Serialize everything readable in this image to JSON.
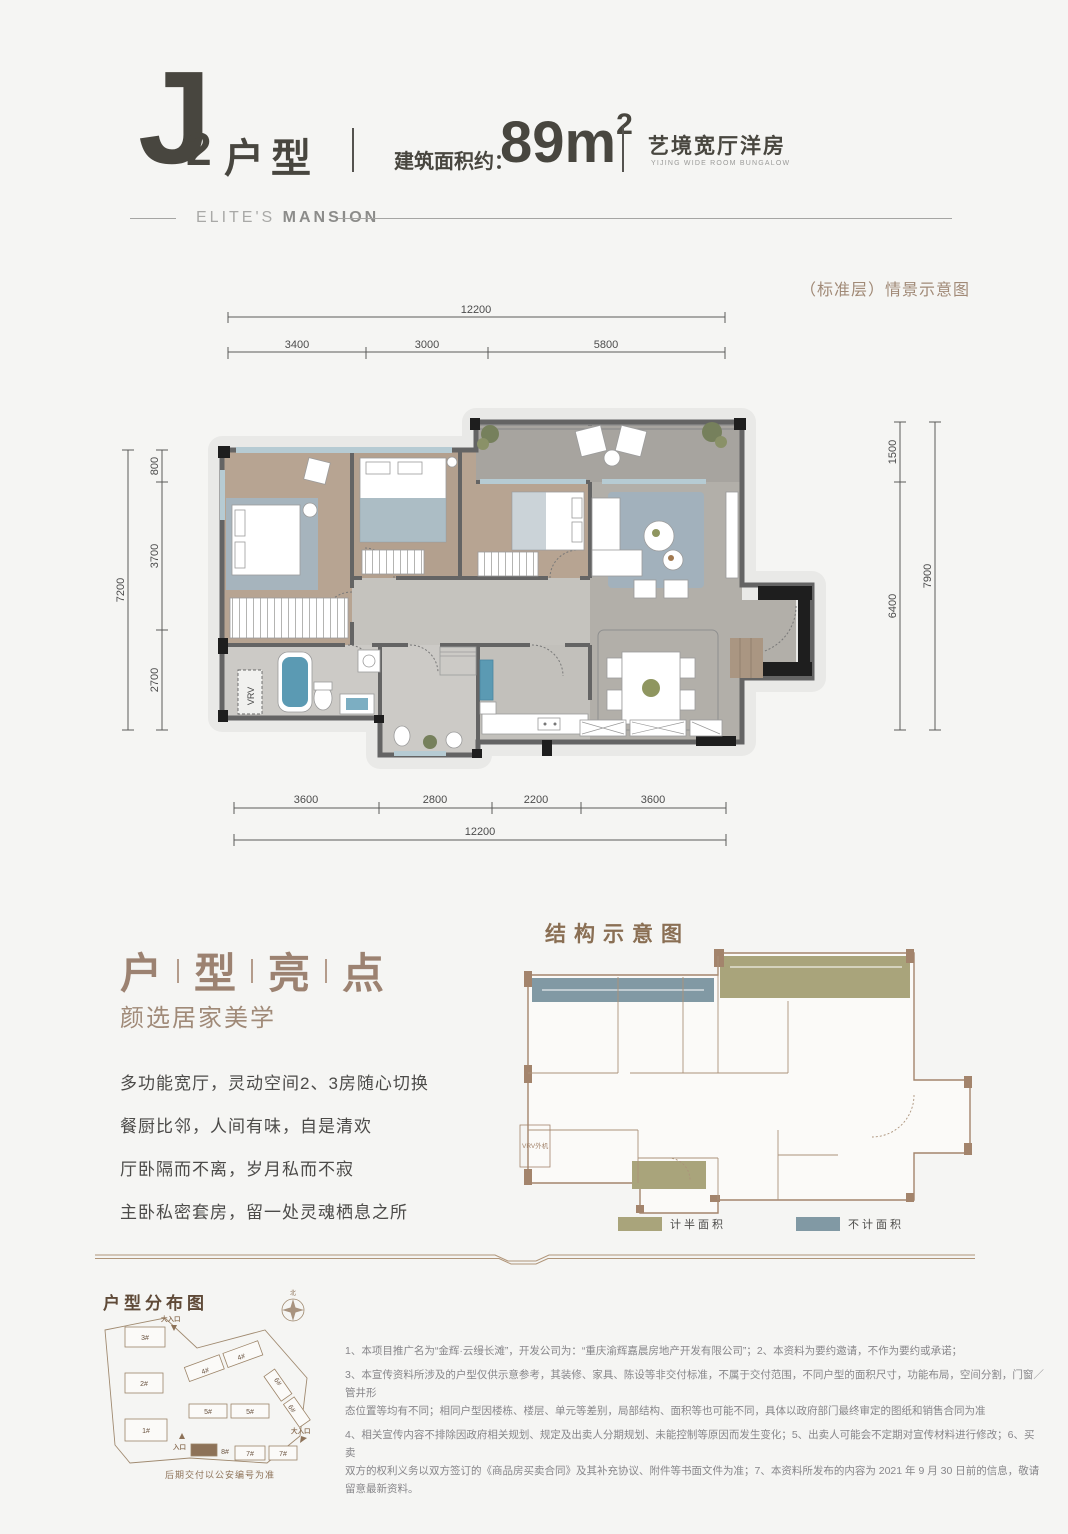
{
  "header": {
    "unit_letter": "J",
    "unit_number": "2",
    "unit_type": "户型",
    "area_label": "建筑面积约：",
    "area_value": "89m",
    "area_exp": "2",
    "tagline_cn": "艺境宽厅洋房",
    "tagline_en": "YIJING WIDE ROOM BUNGALOW",
    "brand_light": "ELITE'S ",
    "brand_bold": "MANSION"
  },
  "plan": {
    "scene_note": "（标准层）情景示意图",
    "vrv_label": "VRV",
    "dims": {
      "top_total": "12200",
      "top_segments": [
        "3400",
        "3000",
        "5800"
      ],
      "left_total": "7200",
      "left_segments": [
        "800",
        "3700",
        "2700"
      ],
      "right_segments": [
        "1500",
        "6400"
      ],
      "right_total": "7900",
      "bottom_segments": [
        "3600",
        "2800",
        "2200",
        "3600"
      ],
      "bottom_total": "12200"
    }
  },
  "highlights": {
    "title_chars": [
      "户",
      "型",
      "亮",
      "点"
    ],
    "subtitle": "颜选居家美学",
    "lines": [
      "多功能宽厅，灵动空间2、3房随心切换",
      "餐厨比邻，人间有味，自是清欢",
      "厅卧隔而不离，岁月私而不寂",
      "主卧私密套房，留一处灵魂栖息之所"
    ]
  },
  "structure": {
    "title": "结构示意图",
    "vrv_label": "VRV外机",
    "legend": [
      {
        "label": "计半面积",
        "color": "#a9a47b"
      },
      {
        "label": "不计面积",
        "color": "#8199a4"
      }
    ]
  },
  "siteplan": {
    "title": "户型分布图",
    "caption": "后期交付以公安编号为准",
    "north": "北",
    "entrance_main_top": "大入口",
    "entrance_left": "入口",
    "entrance_main_right": "大入口",
    "buildings": [
      "3#",
      "2#",
      "1#",
      "4#",
      "4#",
      "5#",
      "5#",
      "6#",
      "6#",
      "8#",
      "7#",
      "7#"
    ]
  },
  "disclaimer": {
    "lines": [
      "1、本项目推广名为“金辉·云缦长滩”，开发公司为：“重庆渝辉嘉晨房地产开发有限公司”；2、本资料为要约邀请，不作为要约或承诺；",
      "3、本宣传资料所涉及的户型仅供示意参考，其装修、家具、陈设等非交付标准，不属于交付范围，不同户型的面积尺寸，功能布局，空间分割，门窗／管井形",
      "态位置等均有不同；相同户型因楼栋、楼层、单元等差别，局部结构、面积等也可能不同，具体以政府部门最终审定的图纸和销售合同为准",
      "4、相关宣传内容不排除因政府相关规划、规定及出卖人分期规划、未能控制等原因而发生变化；5、出卖人可能会不定期对宣传材料进行修改；6、买卖",
      "双方的权利义务以双方签订的《商品房买卖合同》及其补充协议、附件等书面文件为准；7、本资料所发布的内容为 2021 年 9 月 30 日前的信息，敬请留意最新资料。"
    ]
  },
  "colors": {
    "accent_brown": "#a18a77",
    "title_brown": "#9c8271",
    "dark_text": "#48463f",
    "half_area_olive": "#a9a47b",
    "no_area_blue": "#8199a4",
    "wood_floor": "#b7a492",
    "tile_floor": "#b2afa9",
    "water_blue": "#5b9ab3"
  }
}
